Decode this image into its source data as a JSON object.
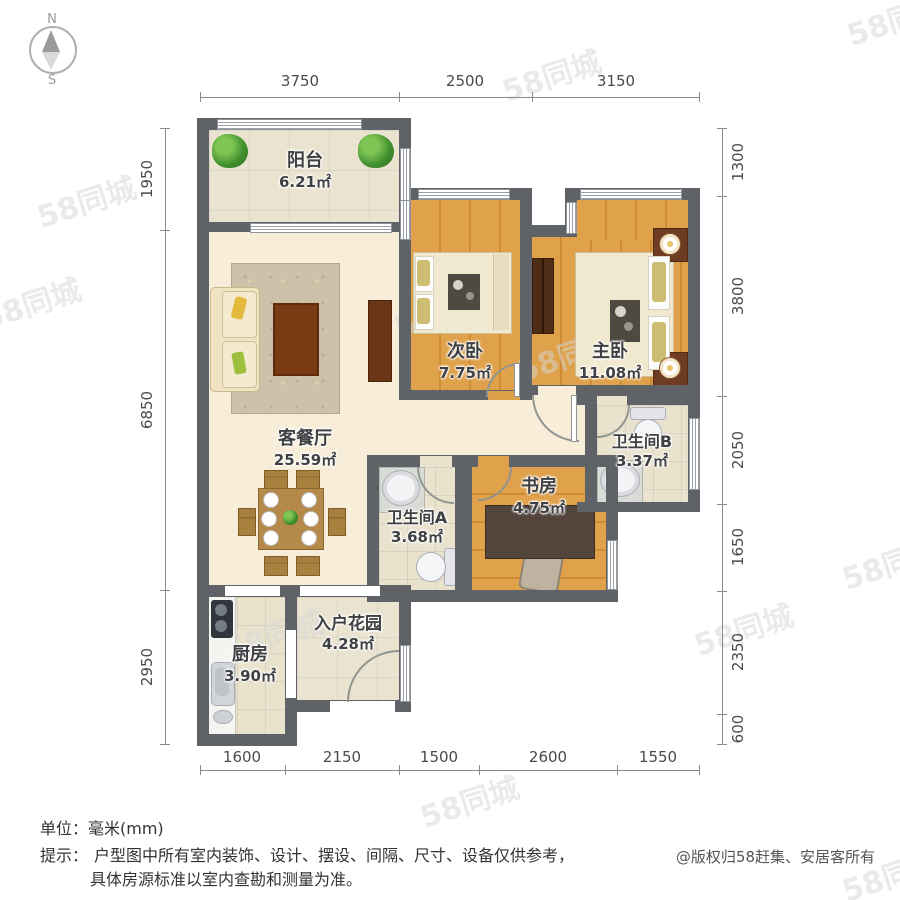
{
  "compass": {
    "north": "N",
    "south": "S"
  },
  "watermark": {
    "text": "58同城"
  },
  "dimensions": {
    "top": [
      "3750",
      "2500",
      "3150"
    ],
    "bottom": [
      "1600",
      "2150",
      "1500",
      "2600",
      "1550"
    ],
    "left": [
      "1950",
      "6850",
      "2950"
    ],
    "right": [
      "1300",
      "3800",
      "2050",
      "1650",
      "2350",
      "600"
    ]
  },
  "rooms": [
    {
      "name": "阳台",
      "area": "6.21㎡"
    },
    {
      "name": "次卧",
      "area": "7.75㎡"
    },
    {
      "name": "主卧",
      "area": "11.08㎡"
    },
    {
      "name": "客餐厅",
      "area": "25.59㎡"
    },
    {
      "name": "卫生间B",
      "area": "3.37㎡"
    },
    {
      "name": "书房",
      "area": "4.75㎡"
    },
    {
      "name": "卫生间A",
      "area": "3.68㎡"
    },
    {
      "name": "厨房",
      "area": "3.90㎡"
    },
    {
      "name": "入户花园",
      "area": "4.28㎡"
    }
  ],
  "footer": {
    "unit_line": "单位：毫米(mm)",
    "tip_label": "提示：",
    "tip_line1": "户型图中所有室内装饰、设计、摆设、间隔、尺寸、设备仅供参考，",
    "tip_line2": "具体房源标准以室内查勘和测量为准。",
    "copyright": "@版权归58赶集、安居客所有"
  }
}
